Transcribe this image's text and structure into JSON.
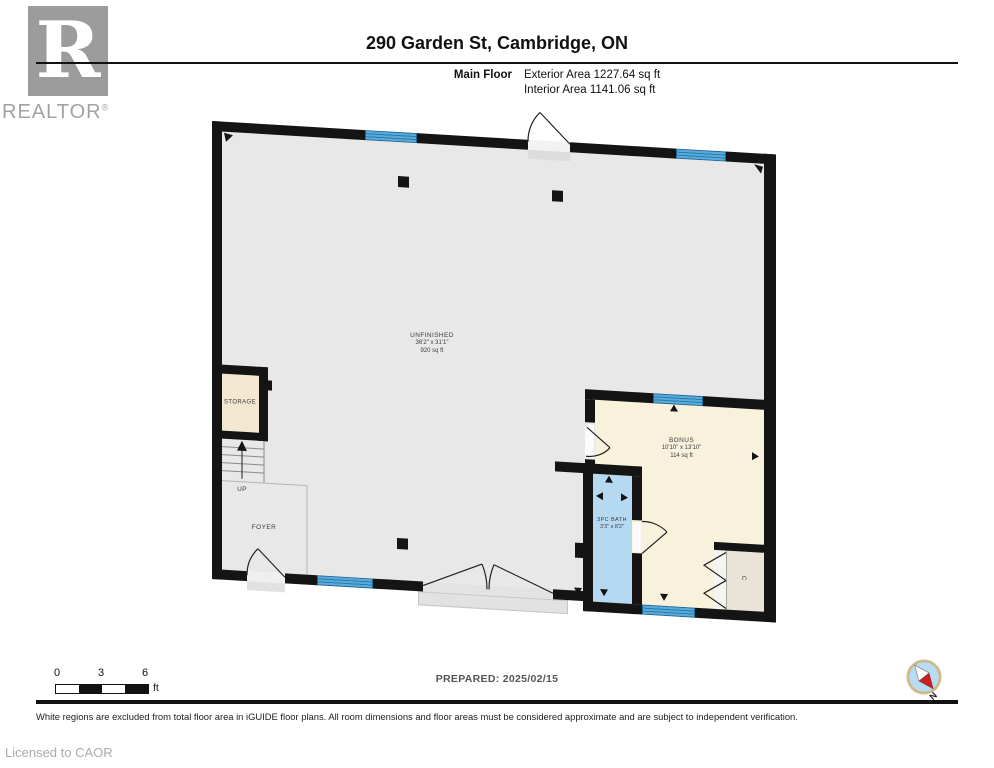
{
  "header": {
    "logo": {
      "r": "R",
      "brand": "REALTOR",
      "mark": "®"
    },
    "title": "290 Garden St, Cambridge, ON",
    "floor_label": "Main Floor",
    "exterior_area": "Exterior Area 1227.64 sq ft",
    "interior_area": "Interior Area 1141.06 sq ft"
  },
  "plan": {
    "rooms": [
      {
        "name": "UNFINISHED",
        "dims": "36'2\" x 31'1\"",
        "area": "920 sq ft"
      },
      {
        "name": "BONUS",
        "dims": "10'10\" x 13'10\"",
        "area": "114 sq ft"
      },
      {
        "name": "3PC BATH",
        "dims": "3'3\" x 8'2\"",
        "area": ""
      },
      {
        "name": "STORAGE"
      },
      {
        "name": "FOYER"
      },
      {
        "name": "UP"
      },
      {
        "name": "C"
      }
    ]
  },
  "footer": {
    "scale": {
      "t0": "0",
      "t3": "3",
      "t6": "6",
      "unit": "ft"
    },
    "prepared": "PREPARED: 2025/02/15",
    "disclaimer": "White regions are excluded from total floor area in iGUIDE floor plans. All room dimensions and floor areas must be considered approximate and are subject to independent verification.",
    "license": "Licensed to CAOR",
    "compass_n": "N"
  },
  "colors": {
    "wall": "#141414",
    "floor_gray": "#e8e8e8",
    "room_cream": "#f8f1dc",
    "bath_blue": "#b6d9f2",
    "window_blue": "#57aad9"
  }
}
